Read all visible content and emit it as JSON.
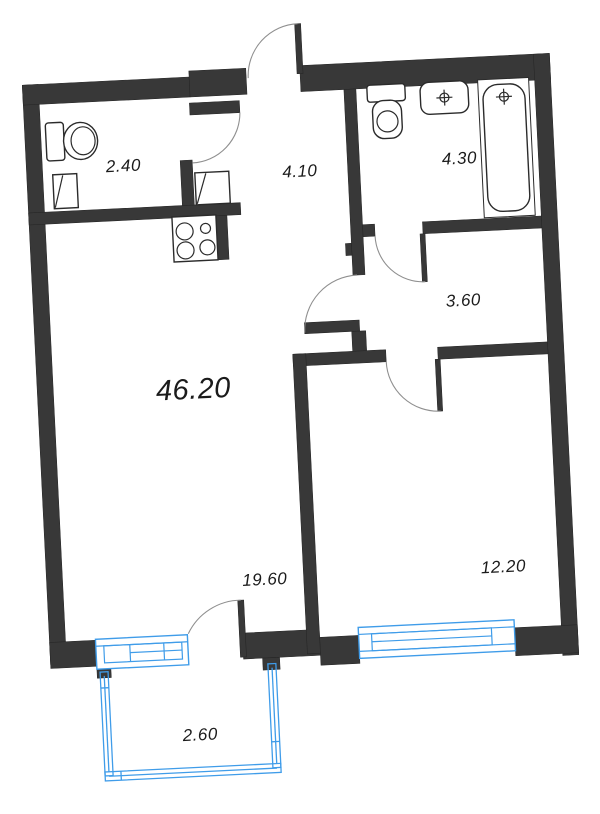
{
  "plan": {
    "type": "apartment-floor-plan",
    "rotation_deg": -2.8,
    "rooms": {
      "total": {
        "area": "46.20",
        "name": "total-area"
      },
      "kitchen_living": {
        "area": "19.60",
        "name": "kitchen-living-room"
      },
      "bedroom": {
        "area": "12.20",
        "name": "bedroom"
      },
      "hallway": {
        "area": "4.10",
        "name": "hallway"
      },
      "wc": {
        "area": "2.40",
        "name": "wc"
      },
      "bathroom": {
        "area": "4.30",
        "name": "bathroom"
      },
      "corridor": {
        "area": "3.60",
        "name": "corridor"
      },
      "balcony": {
        "area": "2.60",
        "name": "balcony"
      }
    },
    "fixtures": [
      "toilet",
      "toilet",
      "sink",
      "bathtub",
      "stove",
      "vent-box",
      "vent-box"
    ],
    "colors": {
      "wall": "#383838",
      "window": "#3f9ce9",
      "arc": "#8f8f8f",
      "fixture": "#2b2b2b",
      "label": "#1b1b1b",
      "background": "#ffffff"
    }
  }
}
